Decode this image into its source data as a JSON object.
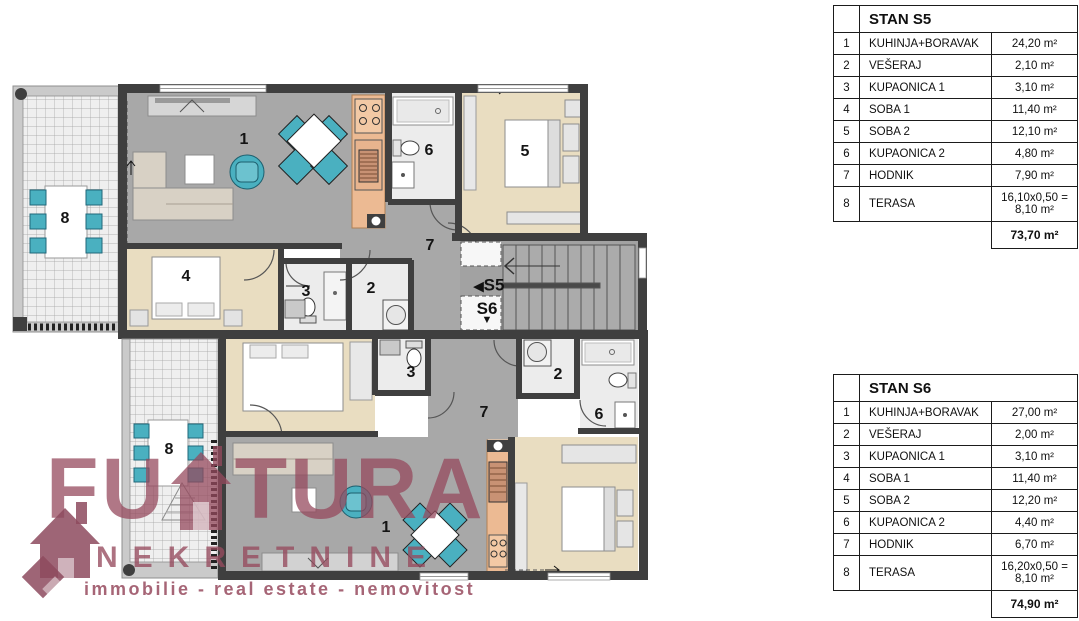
{
  "floor_plan": {
    "room_numbers": {
      "living_kitchen": "1",
      "laundry": "2",
      "bath1": "3",
      "bedroom1": "4",
      "bedroom2": "5",
      "bath2": "6",
      "hall": "7",
      "terrace": "8"
    },
    "stairwell": {
      "s5": "S5",
      "s6": "S6"
    },
    "icons": {
      "left_arrow": "◀",
      "down_arrow": "▼"
    }
  },
  "tables": {
    "s5": {
      "title": "STAN S5",
      "rows": [
        {
          "num": "1",
          "name": "KUHINJA+BORAVAK",
          "area": "24,20 m²"
        },
        {
          "num": "2",
          "name": "VEŠERAJ",
          "area": "2,10 m²"
        },
        {
          "num": "3",
          "name": "KUPAONICA 1",
          "area": "3,10 m²"
        },
        {
          "num": "4",
          "name": "SOBA 1",
          "area": "11,40 m²"
        },
        {
          "num": "5",
          "name": "SOBA 2",
          "area": "12,10 m²"
        },
        {
          "num": "6",
          "name": "KUPAONICA 2",
          "area": "4,80 m²"
        },
        {
          "num": "7",
          "name": "HODNIK",
          "area": "7,90 m²"
        },
        {
          "num": "8",
          "name": "TERASA",
          "area": "16,10x0,50 =\n8,10 m²"
        }
      ],
      "total": "73,70 m²"
    },
    "s6": {
      "title": "STAN S6",
      "rows": [
        {
          "num": "1",
          "name": "KUHINJA+BORAVAK",
          "area": "27,00 m²"
        },
        {
          "num": "2",
          "name": "VEŠERAJ",
          "area": "2,00 m²"
        },
        {
          "num": "3",
          "name": "KUPAONICA 1",
          "area": "3,10 m²"
        },
        {
          "num": "4",
          "name": "SOBA 1",
          "area": "11,40 m²"
        },
        {
          "num": "5",
          "name": "SOBA 2",
          "area": "12,20 m²"
        },
        {
          "num": "6",
          "name": "KUPAONICA 2",
          "area": "4,40 m²"
        },
        {
          "num": "7",
          "name": "HODNIK",
          "area": "6,70 m²"
        },
        {
          "num": "8",
          "name": "TERASA",
          "area": "16,20x0,50 =\n8,10 m²"
        }
      ],
      "total": "74,90 m²"
    }
  },
  "watermark": {
    "word_start": "FU",
    "word_end": "TURA",
    "name": "NEKRETNINE",
    "tagline": "immobilie - real estate - nemovitost"
  },
  "colors": {
    "wall": "#3f3f3f",
    "floor_gray": "#a8a8a8",
    "floor_beige": "#e9ddc1",
    "floor_bath": "#ececec",
    "kitchen": "#ecba93",
    "teal_furniture": "#4ab0c0",
    "terrace_band": "#cacaca",
    "watermark": "#96495e"
  }
}
